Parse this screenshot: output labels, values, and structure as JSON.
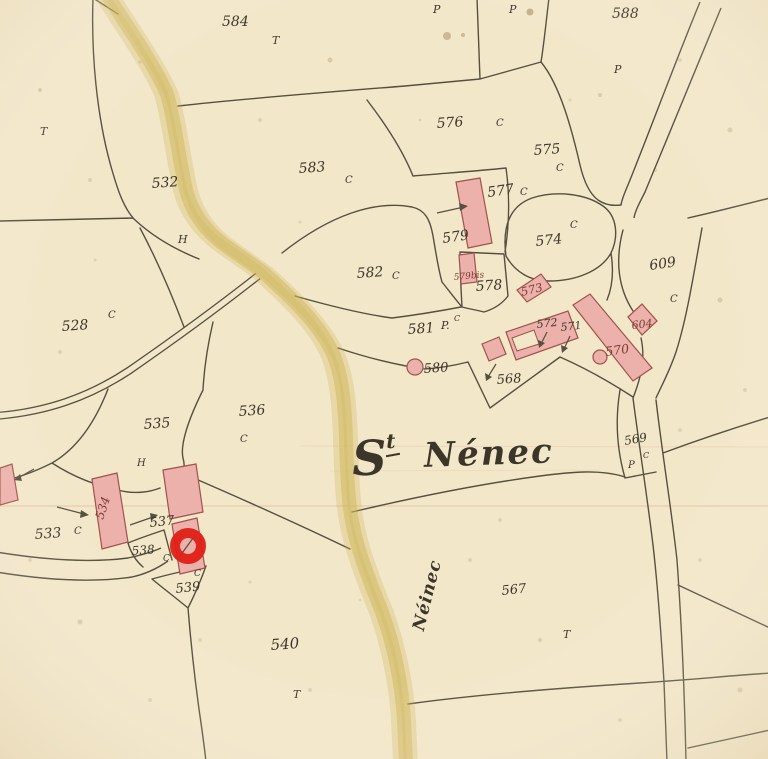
{
  "map": {
    "place_title": {
      "initial": "S",
      "superscript": "t",
      "name": "Nénec"
    },
    "road_label": "Néinec",
    "annotation": {
      "shape": "red-circle",
      "marks_parcel": "537"
    },
    "colors": {
      "paper": "#f3e7ca",
      "ink": "#3c352a",
      "line": "#55503f",
      "building_fill": "#ecb1ab",
      "building_stroke": "#a0524c",
      "road_yellow": "#ccb551",
      "annotation_red": "#e01f15",
      "carmine_label": "#7d3b33",
      "fold_line": "#d79f85"
    },
    "labels": [
      {
        "t": "584",
        "x": 222,
        "y": 26,
        "s": 14,
        "r": 0
      },
      {
        "t": "T",
        "x": 272,
        "y": 44,
        "s": 11,
        "r": 0
      },
      {
        "t": "P",
        "x": 433,
        "y": 13,
        "s": 11,
        "r": 0
      },
      {
        "t": "P",
        "x": 509,
        "y": 13,
        "s": 11,
        "r": 0
      },
      {
        "t": "588",
        "x": 612,
        "y": 18,
        "s": 14,
        "r": 0
      },
      {
        "t": "P",
        "x": 614,
        "y": 73,
        "s": 11,
        "r": 0
      },
      {
        "t": "T",
        "x": 40,
        "y": 135,
        "s": 11,
        "r": 0
      },
      {
        "t": "576",
        "x": 437,
        "y": 128,
        "s": 14,
        "r": -4
      },
      {
        "t": "C",
        "x": 496,
        "y": 126,
        "s": 10,
        "r": 0
      },
      {
        "t": "575",
        "x": 534,
        "y": 155,
        "s": 14,
        "r": -4
      },
      {
        "t": "C",
        "x": 556,
        "y": 171,
        "s": 10,
        "r": 0
      },
      {
        "t": "532",
        "x": 152,
        "y": 188,
        "s": 14,
        "r": -4
      },
      {
        "t": "583",
        "x": 299,
        "y": 173,
        "s": 14,
        "r": -4
      },
      {
        "t": "C",
        "x": 345,
        "y": 183,
        "s": 10,
        "r": 0
      },
      {
        "t": "577",
        "x": 488,
        "y": 197,
        "s": 14,
        "r": -8
      },
      {
        "t": "C",
        "x": 520,
        "y": 195,
        "s": 10,
        "r": 0
      },
      {
        "t": "H",
        "x": 178,
        "y": 243,
        "s": 11,
        "r": 0
      },
      {
        "t": "579",
        "x": 443,
        "y": 243,
        "s": 14,
        "r": -8
      },
      {
        "t": "574",
        "x": 536,
        "y": 246,
        "s": 14,
        "r": -6
      },
      {
        "t": "C",
        "x": 570,
        "y": 228,
        "s": 10,
        "r": 0
      },
      {
        "t": "609",
        "x": 650,
        "y": 270,
        "s": 14,
        "r": -8
      },
      {
        "t": "C",
        "x": 670,
        "y": 302,
        "s": 10,
        "r": 0
      },
      {
        "t": "582",
        "x": 357,
        "y": 278,
        "s": 14,
        "r": -4
      },
      {
        "t": "C",
        "x": 392,
        "y": 279,
        "s": 10,
        "r": 0
      },
      {
        "t": "579bis",
        "x": 454,
        "y": 280,
        "s": 9,
        "r": -5,
        "c": "carmine"
      },
      {
        "t": "578",
        "x": 476,
        "y": 291,
        "s": 14,
        "r": -4
      },
      {
        "t": "573",
        "x": 522,
        "y": 296,
        "s": 11.5,
        "r": -14,
        "c": "carmine"
      },
      {
        "t": "581",
        "x": 408,
        "y": 334,
        "s": 14,
        "r": -4
      },
      {
        "t": "P.",
        "x": 441,
        "y": 329,
        "s": 11,
        "r": 0
      },
      {
        "t": "C",
        "x": 454,
        "y": 321,
        "s": 8,
        "r": 0
      },
      {
        "t": "572",
        "x": 537,
        "y": 328,
        "s": 11,
        "r": -6
      },
      {
        "t": "571",
        "x": 561,
        "y": 331,
        "s": 11,
        "r": -6
      },
      {
        "t": "604",
        "x": 632,
        "y": 329,
        "s": 11,
        "r": -6,
        "c": "carmine"
      },
      {
        "t": "570",
        "x": 606,
        "y": 356,
        "s": 12.5,
        "r": -8,
        "c": "carmine"
      },
      {
        "t": "528",
        "x": 62,
        "y": 331,
        "s": 14,
        "r": -4
      },
      {
        "t": "C",
        "x": 108,
        "y": 318,
        "s": 10,
        "r": 0
      },
      {
        "t": "580",
        "x": 424,
        "y": 373,
        "s": 13,
        "r": -4
      },
      {
        "t": "568",
        "x": 497,
        "y": 384,
        "s": 13,
        "r": -4
      },
      {
        "t": "535",
        "x": 144,
        "y": 429,
        "s": 14,
        "r": -4
      },
      {
        "t": "536",
        "x": 239,
        "y": 416,
        "s": 14,
        "r": -4
      },
      {
        "t": "C",
        "x": 240,
        "y": 442,
        "s": 10,
        "r": 0
      },
      {
        "t": "H",
        "x": 137,
        "y": 466,
        "s": 10,
        "r": 0
      },
      {
        "t": "569",
        "x": 625,
        "y": 445,
        "s": 12,
        "r": -10
      },
      {
        "t": "P",
        "x": 628,
        "y": 468,
        "s": 10,
        "r": 0
      },
      {
        "t": "C",
        "x": 643,
        "y": 458,
        "s": 8,
        "r": 0
      },
      {
        "t": "533",
        "x": 35,
        "y": 539,
        "s": 14,
        "r": -4
      },
      {
        "t": "C",
        "x": 74,
        "y": 534,
        "s": 10,
        "r": 0
      },
      {
        "t": "534",
        "x": 103,
        "y": 520,
        "s": 12,
        "r": -72,
        "c": "carmine"
      },
      {
        "t": "537",
        "x": 150,
        "y": 527,
        "s": 13,
        "r": -6
      },
      {
        "t": "538",
        "x": 132,
        "y": 555,
        "s": 12,
        "r": -4
      },
      {
        "t": "C",
        "x": 163,
        "y": 561,
        "s": 9,
        "r": 0
      },
      {
        "t": "539",
        "x": 176,
        "y": 593,
        "s": 13,
        "r": -6
      },
      {
        "t": "C",
        "x": 194,
        "y": 576,
        "s": 9,
        "r": 0
      },
      {
        "t": "540",
        "x": 271,
        "y": 650,
        "s": 15,
        "r": -4
      },
      {
        "t": "T",
        "x": 293,
        "y": 698,
        "s": 11,
        "r": 0
      },
      {
        "t": "567",
        "x": 502,
        "y": 595,
        "s": 13,
        "r": -6
      },
      {
        "t": "T",
        "x": 563,
        "y": 638,
        "s": 11,
        "r": 0
      }
    ]
  }
}
